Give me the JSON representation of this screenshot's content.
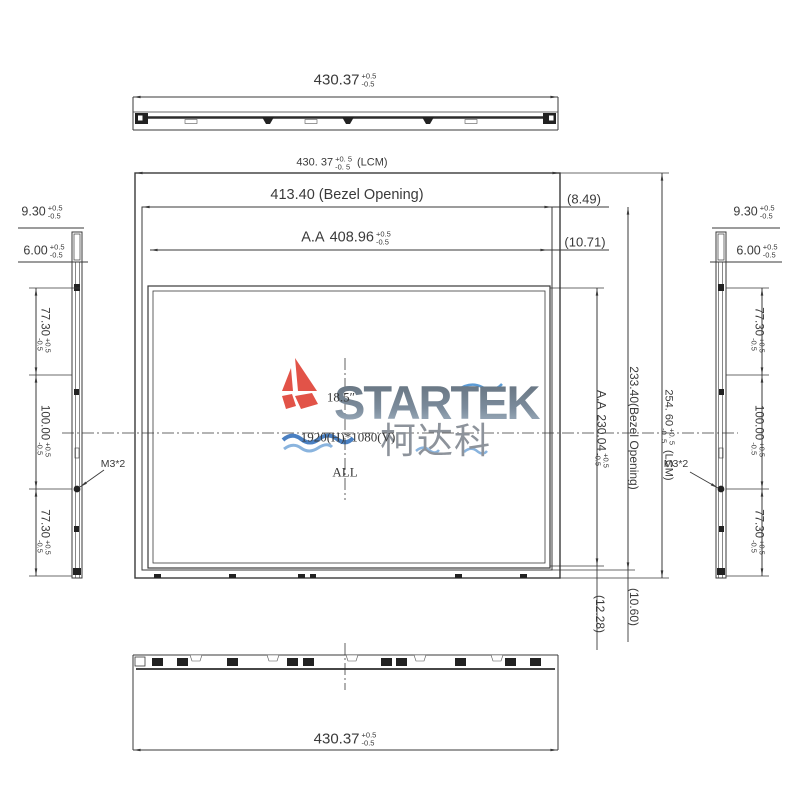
{
  "colors": {
    "line": "#3a3a3a",
    "brand_red": "#e25348",
    "brand_blue": "#4a80c2",
    "brand_blue_light": "#8ab4de",
    "brand_gray": "#7b8b9b",
    "brand_cn_gray": "#8d939b"
  },
  "top_view": {
    "dim": {
      "value": "430.37",
      "plus": "+0.5",
      "minus": "-0.5"
    }
  },
  "bottom_view": {
    "dim": {
      "value": "430.37",
      "plus": "+0.5",
      "minus": "-0.5"
    }
  },
  "front_view": {
    "lcm_width": {
      "value": "430. 37",
      "plus": "+0. 5",
      "minus": "-0. 5",
      "suffix": "(LCM)"
    },
    "bezel_width": "413.40 (Bezel Opening)",
    "aa_width": {
      "prefix": "A.A",
      "value": "408.96",
      "plus": "+0.5",
      "minus": "-0.5"
    },
    "ref_bezel_right": "(8.49)",
    "ref_aa_right": "(10.71)",
    "aa_height": {
      "prefix": "A.A",
      "value": "230.04",
      "plus": "+0.5",
      "minus": "-0.5"
    },
    "bezel_height": "233.40(Bezel Opening)",
    "lcm_height": {
      "value": "254. 60",
      "plus": "+0. 5",
      "minus": "-0. 5",
      "suffix": "(LCM)"
    },
    "ref_aa_bottom": "(12.28)",
    "ref_bezel_bottom": "(10.60)"
  },
  "left_profile": {
    "thickness_total": {
      "value": "9.30",
      "plus": "+0.5",
      "minus": "-0.5"
    },
    "thickness_panel": {
      "value": "6.00",
      "plus": "+0.5",
      "minus": "-0.5"
    },
    "seg_top": {
      "value": "77.30",
      "plus": "+0.5",
      "minus": "-0.5"
    },
    "seg_mid": {
      "value": "100.00",
      "plus": "+0.5",
      "minus": "-0.5"
    },
    "seg_bottom": {
      "value": "77.30",
      "plus": "+0.5",
      "minus": "-0.5"
    },
    "screw_note": "M3*2"
  },
  "right_profile": {
    "thickness_total": {
      "value": "9.30",
      "plus": "+0.5",
      "minus": "-0.5"
    },
    "thickness_panel": {
      "value": "6.00",
      "plus": "+0.5",
      "minus": "-0.5"
    },
    "seg_top": {
      "value": "77.30",
      "plus": "+0.5",
      "minus": "-0.5"
    },
    "seg_mid": {
      "value": "100.00",
      "plus": "+0.5",
      "minus": "-0.5"
    },
    "seg_bottom": {
      "value": "77.30",
      "plus": "+0.5",
      "minus": "-0.5"
    },
    "screw_note": "M3*2"
  },
  "panel_info": {
    "size": "18.5″",
    "resolution": "1920(H)*1080(V)",
    "grade": "ALL"
  },
  "logo": {
    "brand": "STARTEK",
    "brand_cn": "柯达科"
  }
}
